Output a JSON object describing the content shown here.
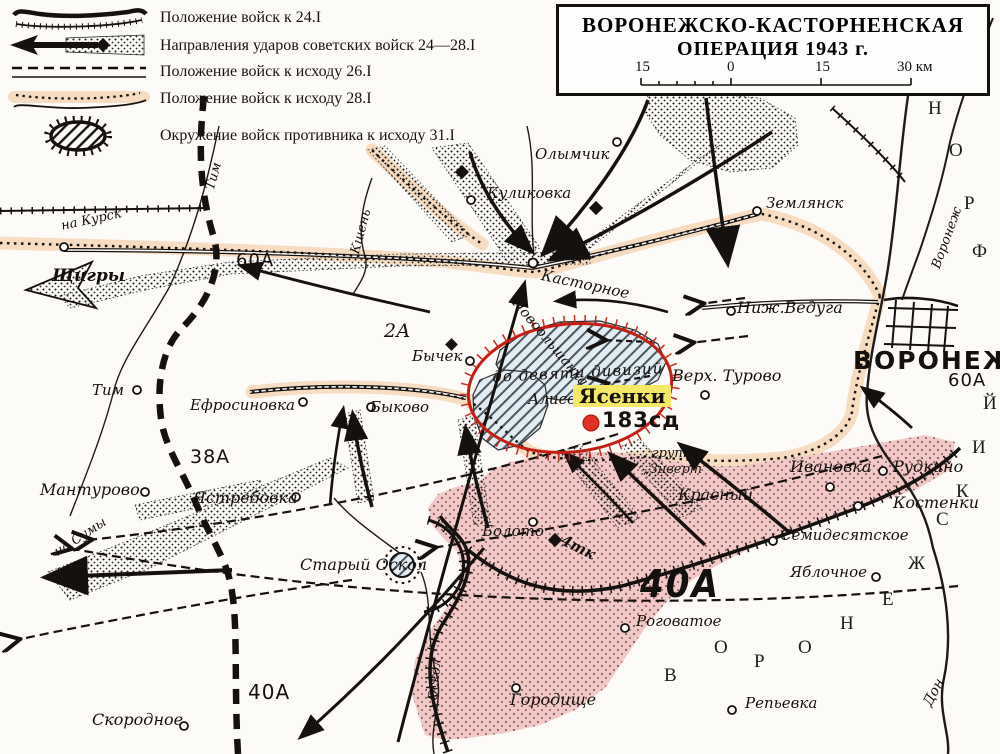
{
  "legend": {
    "items": [
      {
        "label": "Положение войск к 24.I"
      },
      {
        "label": "Направления ударов советских войск 24—28.I"
      },
      {
        "label": "Положение войск к исходу 26.I"
      },
      {
        "label": "Положение войск к исходу 28.I"
      },
      {
        "label": "Окружение войск противника к исходу 31.I"
      }
    ]
  },
  "title": {
    "line1": "ВОРОНЕЖСКО-КАСТОРНЕНСКАЯ",
    "line2": "ОПЕРАЦИЯ 1943 г.",
    "scale": {
      "t1": "15",
      "t2": "0",
      "t3": "15",
      "t4": "30 км"
    }
  },
  "front_label": "ВОРОНЕЖСКИЙ ФРОНТ",
  "labels": {
    "olymchik": "Олымчик",
    "kulikovka": "Куликовка",
    "zemlyansk": "Землянск",
    "kastornoye": "Касторное",
    "shchigry": "Щигры",
    "tim_river": "Тим",
    "tim_town": "Тим",
    "kshen_river": "Кшень",
    "a2": "2А",
    "a60_left": "60А",
    "a60_right": "60А",
    "a38": "38А",
    "a40_big": "40А",
    "a40_left": "40А",
    "bychek": "Бычек",
    "nizh_veduga": "Ниж.Ведуга",
    "verh_turovo": "Верх. Турово",
    "voronezh_city": "ВОРОНЕЖ",
    "voronezh_river": "Воронеж",
    "efrosinovka": "Ефросиновка",
    "bykovo": "Быково",
    "manturovo": "Мантурово",
    "yastrebovka": "Ястребовка",
    "na_kursk": "на Курск",
    "na_sumy": "на Сумы",
    "stary_oskol": "Старый Оскол",
    "boloto": "Болото",
    "tank4": "4тк",
    "gorodishche": "Городище",
    "oskol_river": "Оскол",
    "skorodnoye": "Скородное",
    "rogovatoye": "Роговатое",
    "repyevka": "Репьевка",
    "yablochnoye": "Яблочное",
    "semidesyatskoye": "Семидесятское",
    "krasny": "Красный",
    "ivanovka": "Ивановка",
    "rudkino": "Рудкино",
    "kostenki": "Костенки",
    "gruppa_line1": "группа",
    "gruppa_line2": "„Зиверт“",
    "nine_divisions": "до девяти дивизий",
    "aliso": "Алисо",
    "yasenki": "Ясенки",
    "division183": "183сд",
    "novoolshanka": "Новоольшанка",
    "don_river": "Дон"
  },
  "colors": {
    "peach": "#f7dcc0",
    "pink": "#f2c9c7",
    "red": "#c41f12",
    "yellow": "#f5e868",
    "hatch_bg": "#e3ecf2",
    "ink": "#1a1a1a"
  }
}
